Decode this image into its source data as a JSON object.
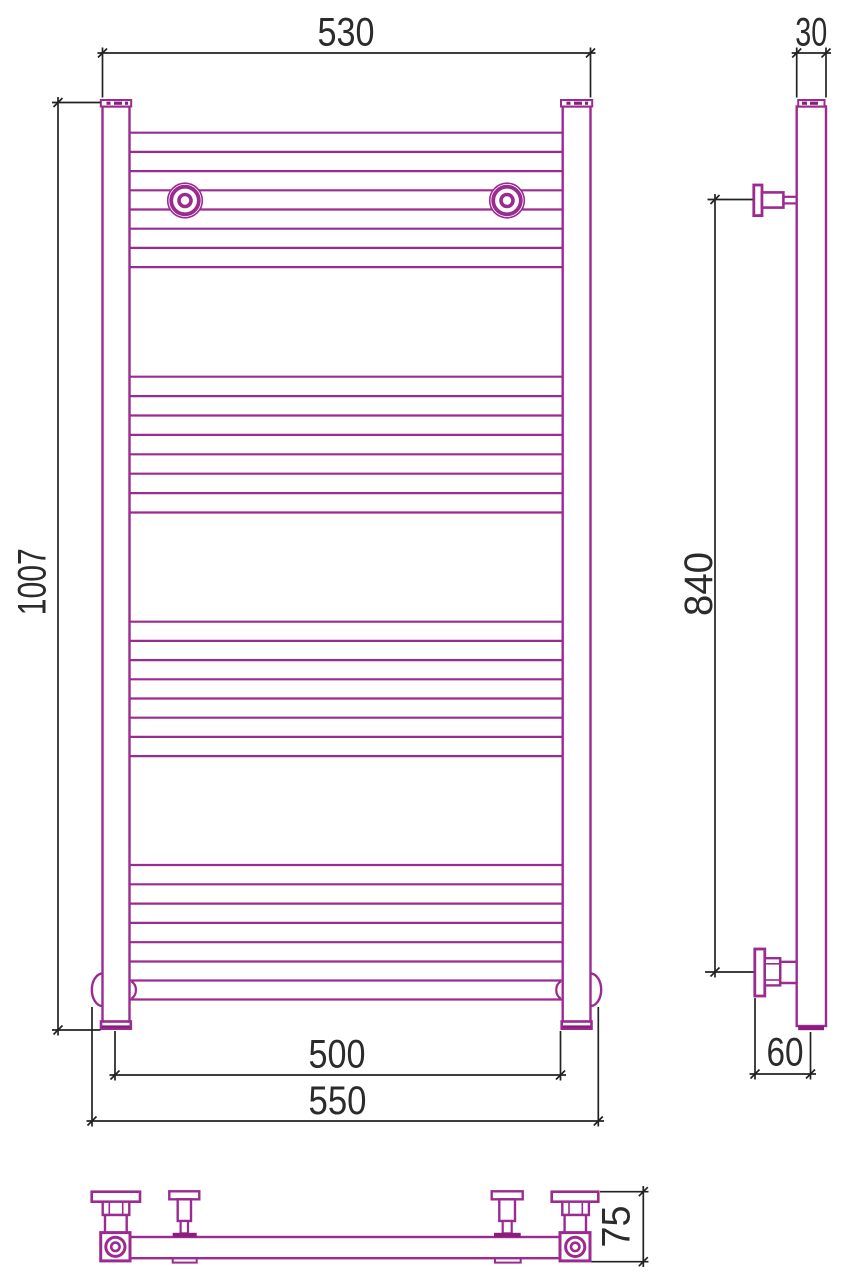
{
  "drawing": {
    "kind": "technical-drawing",
    "subject": "heated towel rail, three orthographic views",
    "views": [
      "front-view",
      "side-view",
      "bottom-view"
    ]
  },
  "colors": {
    "outline": "#9B2B91",
    "outline_dark": "#8A1D7D",
    "dimension_line": "#222222",
    "dimension_text": "#2B2B2B",
    "background": "#FFFFFF"
  },
  "dimensions": {
    "overall_width": {
      "value": "530"
    },
    "tube_diameter": {
      "value": "30"
    },
    "overall_height": {
      "value": "1007"
    },
    "bracket_span": {
      "value": "840"
    },
    "post_axis_spacing": {
      "value": "500"
    },
    "bottom_tube_length": {
      "value": "550"
    },
    "wall_to_axis": {
      "value": "60"
    },
    "depth": {
      "value": "75"
    }
  },
  "front_view": {
    "rung_x": [
      129.5,
      562.7
    ],
    "rung_groups": [
      [
        132.7,
        151.9,
        171.1,
        190.3,
        209.5,
        228.7,
        247.9,
        267.1
      ],
      [
        376.7,
        396.1,
        415.5,
        434.9,
        454.3,
        473.7,
        493.1,
        512.5
      ],
      [
        621.7,
        640.9,
        660.1,
        679.3,
        698.5,
        717.7,
        736.9,
        756.1
      ],
      [
        865.0,
        884.3,
        903.6,
        922.9,
        942.2,
        961.5
      ],
      [
        980.5,
        999.5
      ]
    ]
  },
  "dimension_ticks": [
    [
      102.5,
      53
    ],
    [
      590.5,
      53
    ],
    [
      796.7,
      53
    ],
    [
      826,
      53
    ],
    [
      58,
      102.5
    ],
    [
      58,
      1030
    ],
    [
      715,
      199.5
    ],
    [
      715,
      972
    ],
    [
      115,
      1075
    ],
    [
      560.5,
      1075
    ],
    [
      92,
      1121
    ],
    [
      598.3,
      1121
    ],
    [
      755,
      1074
    ],
    [
      810.5,
      1074
    ],
    [
      643.3,
      1191.7
    ],
    [
      643.3,
      1261.7
    ]
  ]
}
